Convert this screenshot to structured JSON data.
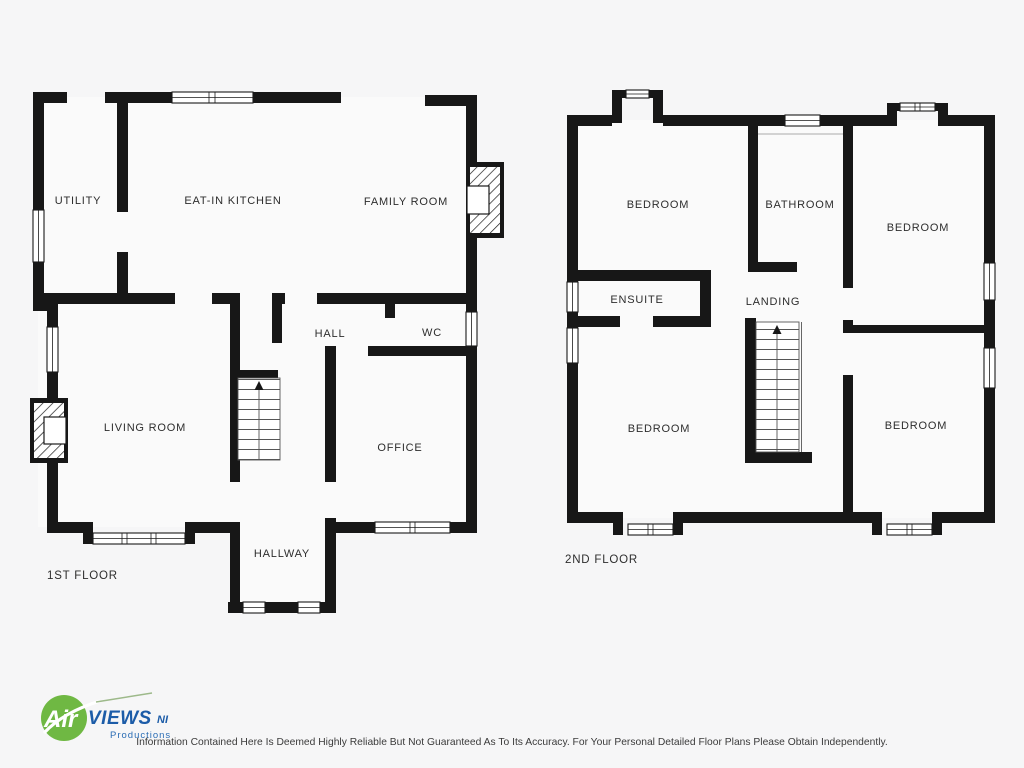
{
  "floor1": {
    "title": "1ST FLOOR",
    "rooms": {
      "utility": "UTILITY",
      "kitchen": "EAT-IN KITCHEN",
      "family": "FAMILY ROOM",
      "hall": "HALL",
      "wc": "WC",
      "living": "LIVING ROOM",
      "office": "OFFICE",
      "hallway": "HALLWAY"
    }
  },
  "floor2": {
    "title": "2ND FLOOR",
    "rooms": {
      "bedroom_tl": "BEDROOM",
      "bathroom": "BATHROOM",
      "bedroom_tr": "BEDROOM",
      "ensuite": "ENSUITE",
      "landing": "LANDING",
      "bedroom_bl": "BEDROOM",
      "bedroom_br": "BEDROOM"
    }
  },
  "logo": {
    "air": "Air",
    "views": "VIEWS",
    "ni": "NI",
    "productions": "Productions"
  },
  "footer": {
    "disclaimer": "Information Contained Here Is Deemed Highly Reliable But Not Guaranteed As To Its Accuracy. For Your Personal Detailed Floor Plans Please Obtain Independently."
  },
  "colors": {
    "background": "#f6f6f7",
    "wall": "#171717",
    "logo_green": "#6fb843",
    "logo_blue": "#1c5ca8"
  }
}
